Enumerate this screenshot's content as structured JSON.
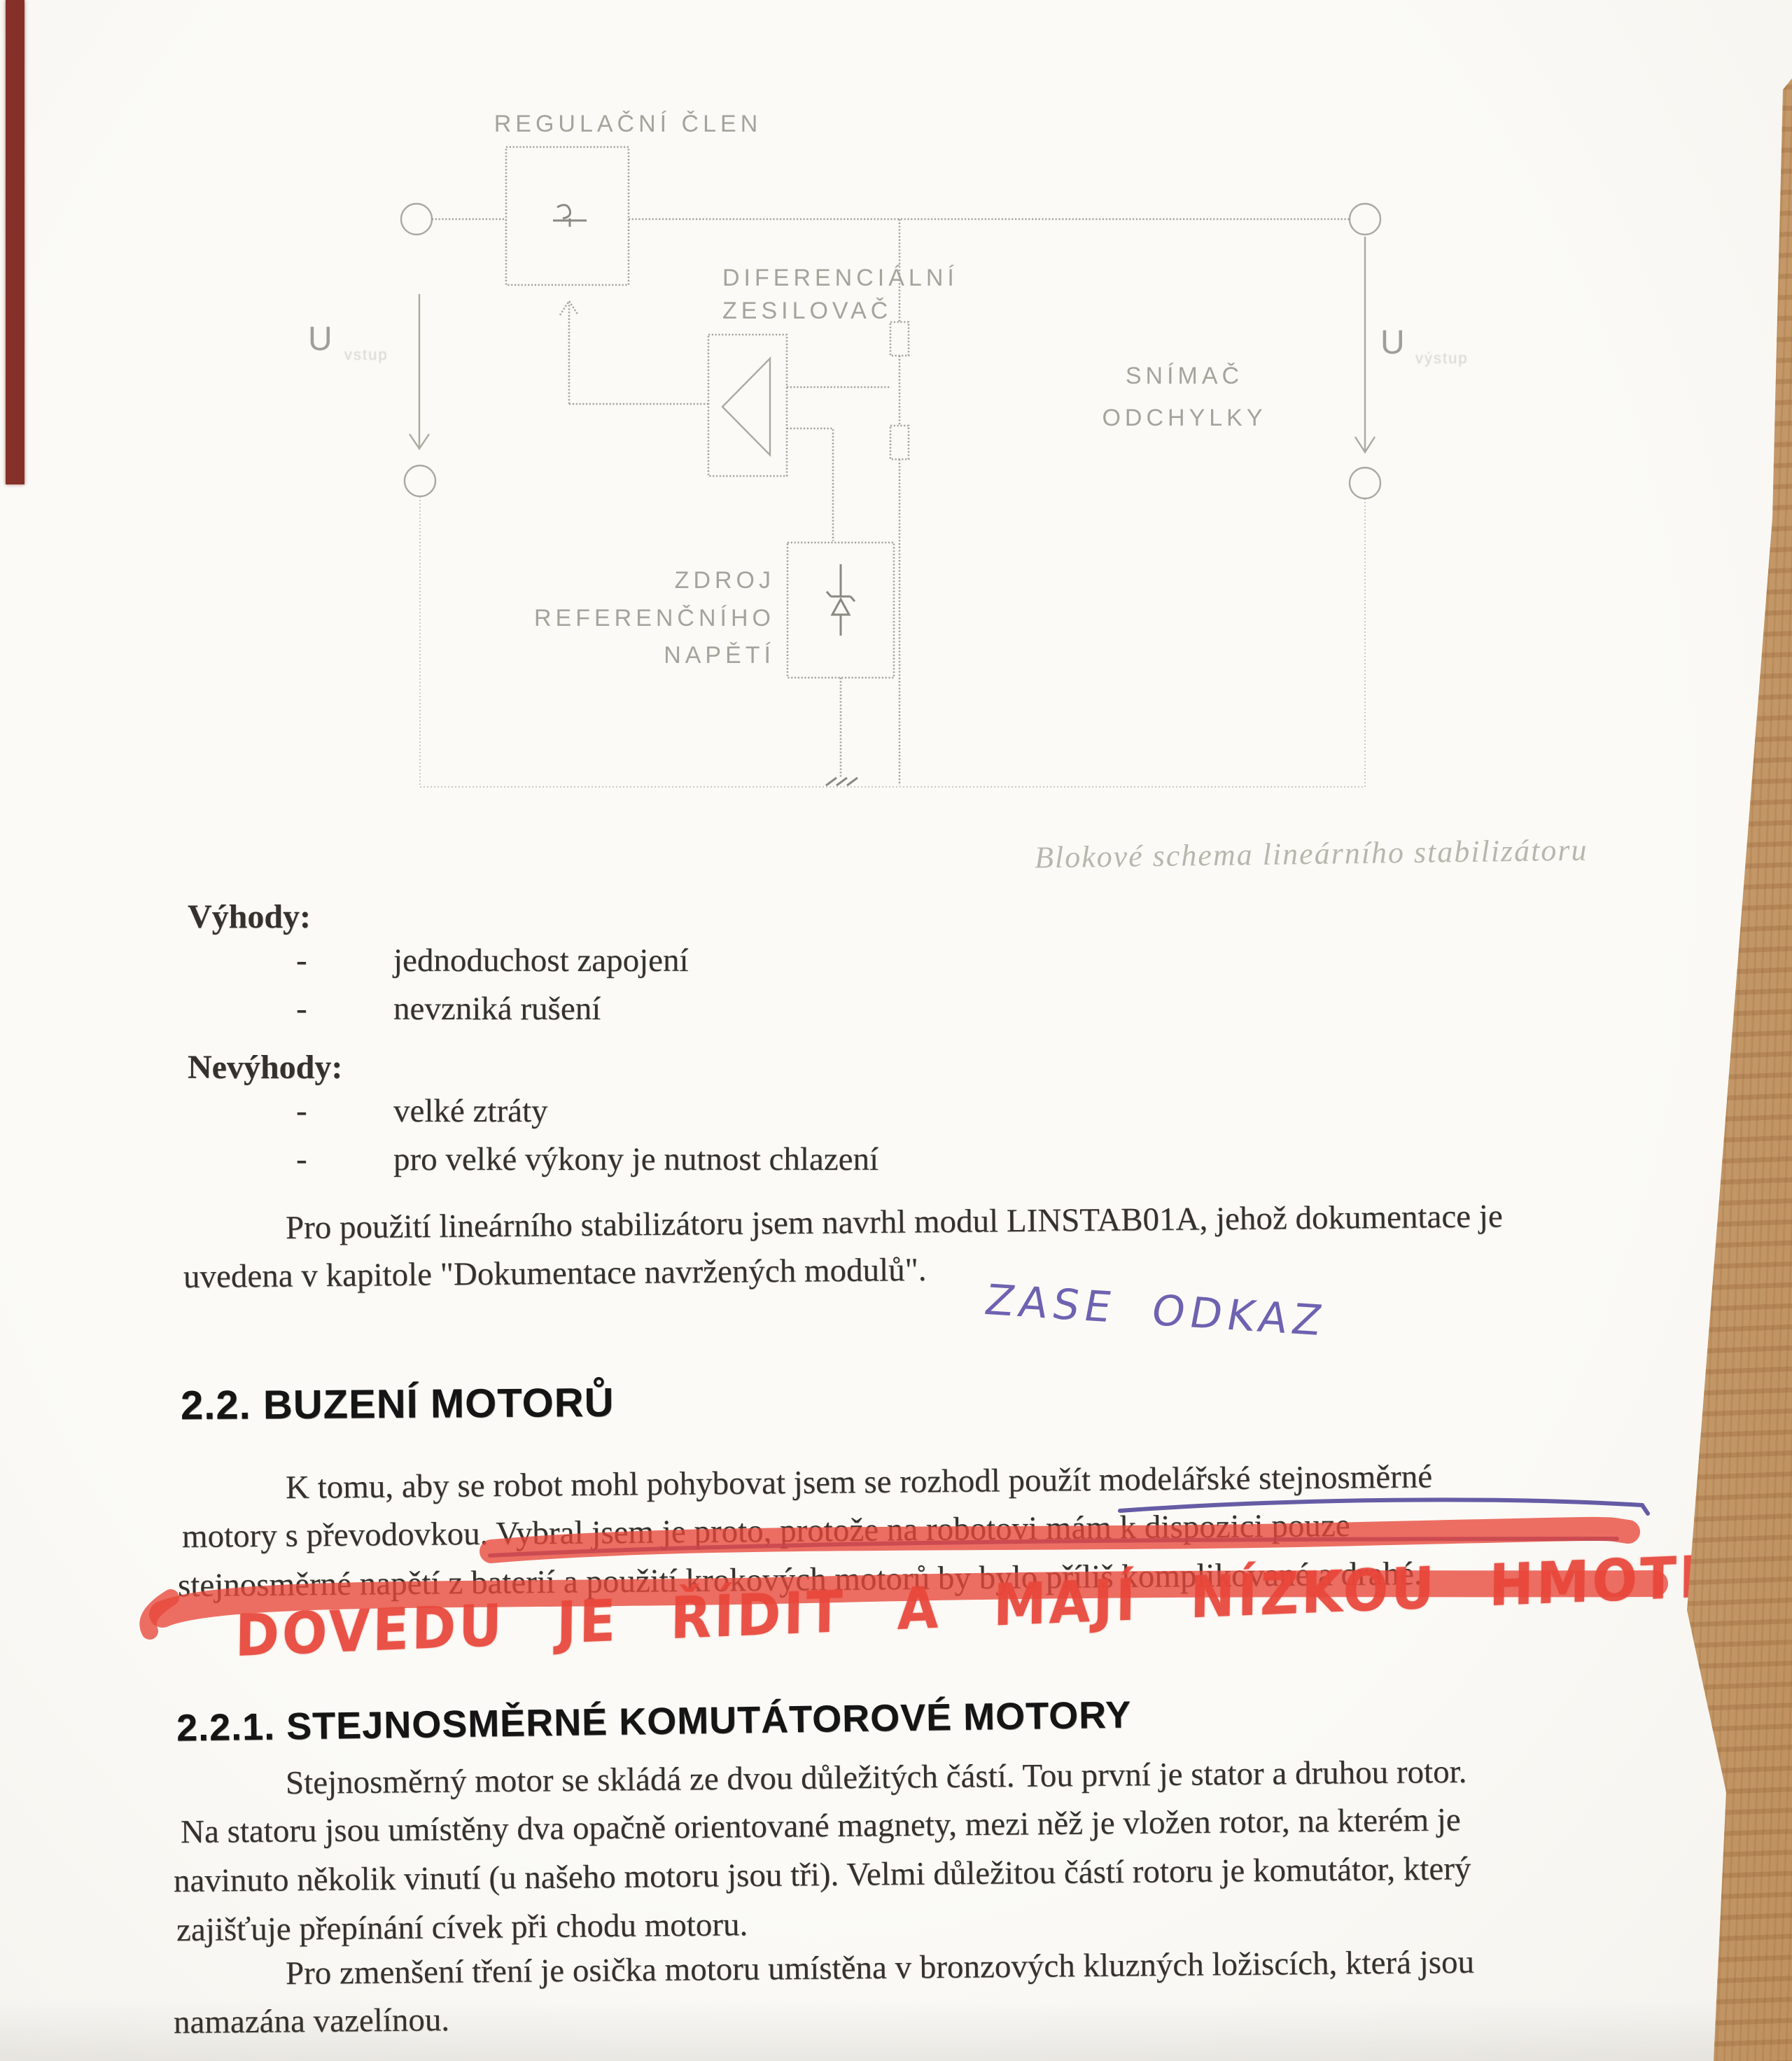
{
  "colors": {
    "paper": "#fbfaf6",
    "ink": "#35322d",
    "heading": "#151515",
    "diagram_line": "#9b9b93",
    "caption": "#b8b7ae",
    "marker_red": "#e8463a",
    "pen_blue": "#4a3f96",
    "hand_blue": "#5b4ea8",
    "wood": "#c49a6c",
    "red_strip": "#7c2018"
  },
  "diagram": {
    "labels": {
      "regulator": "REGULAČNÍ ČLEN",
      "diff_amp_line1": "DIFERENCIÁLNÍ",
      "diff_amp_line2": "ZESILOVAČ",
      "sensor_line1": "SNÍMAČ",
      "sensor_line2": "ODCHYLKY",
      "ref_line1": "ZDROJ",
      "ref_line2": "REFERENČNÍHO",
      "ref_line3": "NAPĚTÍ",
      "u_input": "U",
      "u_input_sub": "vstup",
      "u_output": "U",
      "u_output_sub": "výstup"
    },
    "caption": "Blokové schema lineárního stabilizátoru"
  },
  "advantages": {
    "title": "Výhody:",
    "bullet": "-",
    "items": [
      "jednoduchost zapojení",
      "nevzniká rušení"
    ]
  },
  "disadvantages": {
    "title": "Nevýhody:",
    "bullet": "-",
    "items": [
      "velké ztráty",
      "pro velké výkony je nutnost chlazení"
    ]
  },
  "paragraph_linstab": {
    "lines": [
      "Pro použití lineárního stabilizátoru jsem navrhl modul LINSTAB01A, jehož dokumentace je",
      "uvedena v kapitole \"Dokumentace navržených modulů\"."
    ]
  },
  "handwritten_blue": {
    "text": "ZASE ODKAZ"
  },
  "section_2_2": {
    "title": "2.2. BUZENÍ MOTORŮ"
  },
  "paragraph_motors": {
    "lines": [
      "K tomu, aby se robot mohl pohybovat jsem se rozhodl použít modelářské stejnosměrné",
      "motory s převodovkou. Vybral jsem je proto, protože na robotovi mám k dispozici pouze",
      "stejnosměrné napětí z baterií a použití krokových motorů by bylo příliš komplikované a drahé."
    ]
  },
  "handwritten_red": {
    "text": "DOVEDU JE ŘÍDIT A MAJÍ NÍZKOU HMOTNOST"
  },
  "section_2_2_1": {
    "title": "2.2.1. STEJNOSMĚRNÉ KOMUTÁTOROVÉ MOTORY"
  },
  "paragraph_dc_motor": {
    "lines": [
      "Stejnosměrný motor se skládá ze dvou důležitých částí. Tou první je stator a druhou rotor.",
      "Na statoru jsou umístěny dva opačně orientované magnety, mezi něž je vložen rotor, na kterém je",
      "navinuto několik vinutí (u našeho motoru jsou tři). Velmi důležitou částí rotoru je komutátor, který",
      "zajišťuje přepínání cívek při chodu motoru."
    ]
  },
  "paragraph_bearings": {
    "lines": [
      "Pro zmenšení tření je osička motoru umístěna v bronzových kluzných ložiscích, která jsou",
      "namazána vazelínou."
    ]
  }
}
